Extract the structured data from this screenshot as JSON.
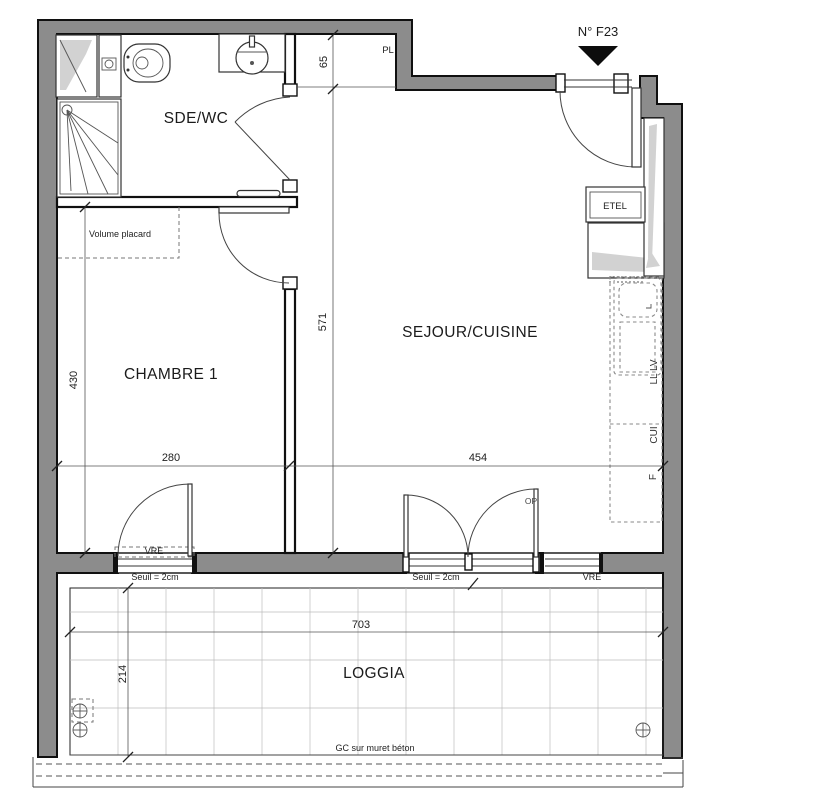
{
  "plan": {
    "unit": "N° F23",
    "rooms": {
      "bathroom": "SDE/WC",
      "bedroom": "CHAMBRE 1",
      "living": "SEJOUR/CUISINE",
      "loggia": "LOGGIA"
    },
    "labels": {
      "volume_placard": "Volume placard",
      "pl": "PL",
      "etel": "ETEL",
      "vre_bedroom": "VRE",
      "vre_living": "VRE",
      "seuil_bedroom": "Seuil = 2cm",
      "seuil_living": "Seuil = 2cm",
      "op": "OP",
      "ll_lv": "LL LV",
      "cui": "CUI",
      "fridge": "F",
      "gc_note": "GC sur muret béton"
    },
    "dims": {
      "pl_depth": "65",
      "living_len": "571",
      "bedroom_len": "430",
      "bedroom_w": "280",
      "living_w": "454",
      "loggia_w": "703",
      "loggia_d": "214"
    },
    "colors": {
      "wall": "#8c8c8c",
      "duct": "#d2d2d2",
      "grid": "#bcbcbc",
      "ink": "#1b1b1b"
    }
  }
}
